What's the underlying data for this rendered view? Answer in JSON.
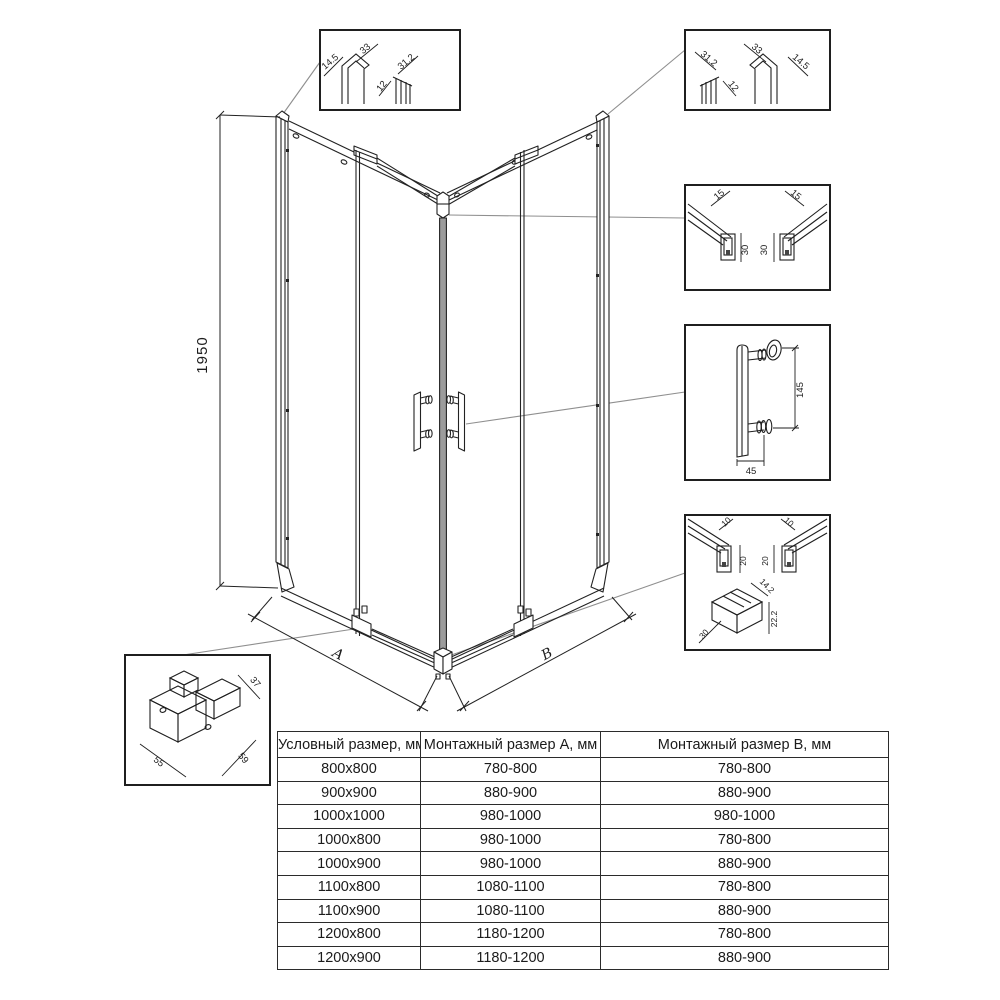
{
  "drawing": {
    "height_dim": "1950",
    "dim_a": "A",
    "dim_b": "B"
  },
  "callouts": {
    "top_left_profile": {
      "flange": "14.5",
      "width": "33",
      "gap": "12",
      "depth": "31.2"
    },
    "top_right_profile": {
      "depth": "31.2",
      "gap": "12",
      "width": "33",
      "flange": "14.5"
    },
    "top_rail": {
      "left_width": "15",
      "left_height": "30",
      "right_width": "15",
      "right_height": "30"
    },
    "handle": {
      "hole_spacing": "145",
      "offset": "45"
    },
    "bottom_rail": {
      "left_width": "10",
      "right_width": "10",
      "left_height": "20",
      "right_height": "20",
      "corner_width": "14.2",
      "corner_height": "22.2",
      "corner_depth": "30"
    },
    "corner_connector": {
      "depth": "37",
      "side_a": "55",
      "side_b": "59"
    }
  },
  "table": {
    "headers": [
      "Условный размер, мм",
      "Монтажный размер А, мм",
      "Монтажный размер В, мм"
    ],
    "rows": [
      [
        "800x800",
        "780-800",
        "780-800"
      ],
      [
        "900x900",
        "880-900",
        "880-900"
      ],
      [
        "1000x1000",
        "980-1000",
        "980-1000"
      ],
      [
        "1000x800",
        "980-1000",
        "780-800"
      ],
      [
        "1000x900",
        "980-1000",
        "880-900"
      ],
      [
        "1100x800",
        "1080-1100",
        "780-800"
      ],
      [
        "1100x900",
        "1080-1100",
        "880-900"
      ],
      [
        "1200x800",
        "1180-1200",
        "780-800"
      ],
      [
        "1200x900",
        "1180-1200",
        "880-900"
      ]
    ]
  }
}
